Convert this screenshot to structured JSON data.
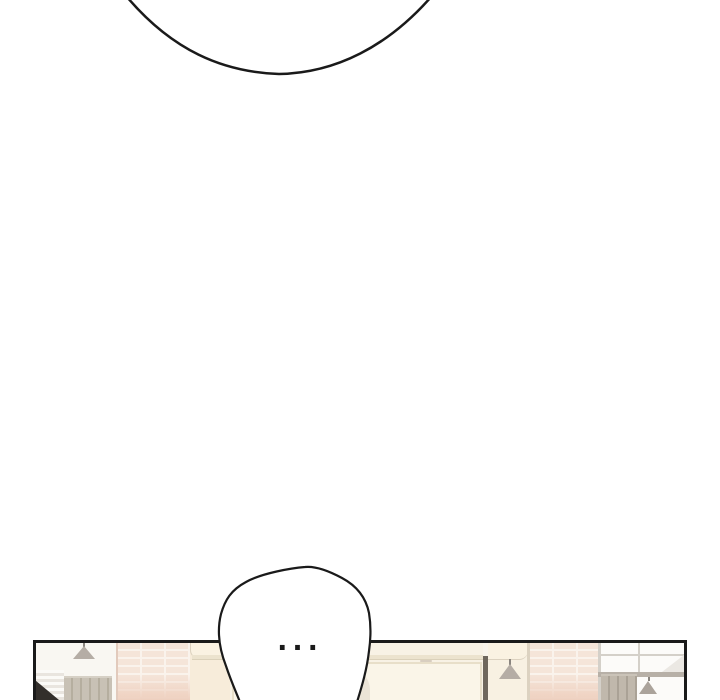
{
  "comic": {
    "speech_bubble_text": "..."
  },
  "colors": {
    "page-bg": "#ffffff",
    "ink": "#1a1a1a",
    "bubble-fill": "#ffffff",
    "panel-cream": "#f9f4ea",
    "wall-left": "#f9f7f2",
    "lamp-gray": "#b5ada5",
    "lamp-gray2": "#aba39b",
    "blind-light": "#fbfaf7",
    "blind-dark": "#e9e5df",
    "wedge": "#332f2b",
    "curtain": "#c8c1b5",
    "curtain-dark": "#b5ae9f",
    "curtain-top": "#d6d0c5",
    "brick-base": "#f5e5d9",
    "brick-mortar": "#faf3ec",
    "brick-tint": "#eed0bf",
    "brick-edge": "#e2cabc",
    "pillar": "#f7ecda",
    "pillar-trim": "#faf2e2",
    "trim-line": "#dcd2c0",
    "store-bg": "#f8f2e5",
    "rail": "#ece3ce",
    "rail-line": "#dbd1ba",
    "store-panel": "#faf5e8",
    "store-line": "#e8dfc9",
    "ghost": "#ebe4d6",
    "smudge": "#d8cec0",
    "divider": "#6f675c",
    "cream2": "#f8f1e2",
    "glass": "#fcfbf9",
    "mullion": "#d4d0c9",
    "reflection": "#ebe8e3",
    "rail2": "#b7b0a7",
    "drape": "#c0b8ac",
    "drape-dark": "#aaa296",
    "drape-top": "#cac3b8"
  }
}
